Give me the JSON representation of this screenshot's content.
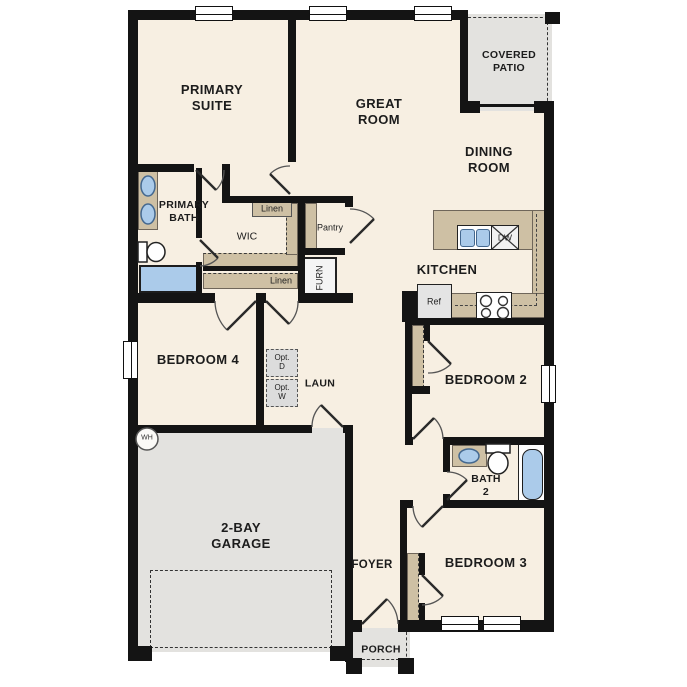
{
  "plan": {
    "rooms": {
      "primary_suite": "PRIMARY\nSUITE",
      "great_room": "GREAT\nROOM",
      "covered_patio": "COVERED\nPATIO",
      "dining_room": "DINING\nROOM",
      "primary_bath": "PRIMARY\nBATH",
      "wic": "WIC",
      "kitchen": "KITCHEN",
      "bedroom4": "BEDROOM 4",
      "laundry": "LAUN",
      "bedroom2": "BEDROOM 2",
      "garage": "2-BAY\nGARAGE",
      "bath2": "BATH\n2",
      "foyer": "FOYER",
      "bedroom3": "BEDROOM 3",
      "porch": "PORCH"
    },
    "fixtures": {
      "linen_top": "Linen",
      "linen_hall": "Linen",
      "pantry": "Pantry",
      "furnace": "FURN",
      "fridge": "Ref",
      "dishwasher": "DW",
      "water_heater": "WH",
      "opt_dryer": "Opt.\nD",
      "opt_washer": "Opt.\nW"
    },
    "colors": {
      "floor": "#f7efe2",
      "wall": "#141414",
      "counter": "#cec0a4",
      "outdoor": "#e3e2df",
      "fixture_blue": "#abcbea",
      "opt_box": "#dcdcdc"
    }
  }
}
